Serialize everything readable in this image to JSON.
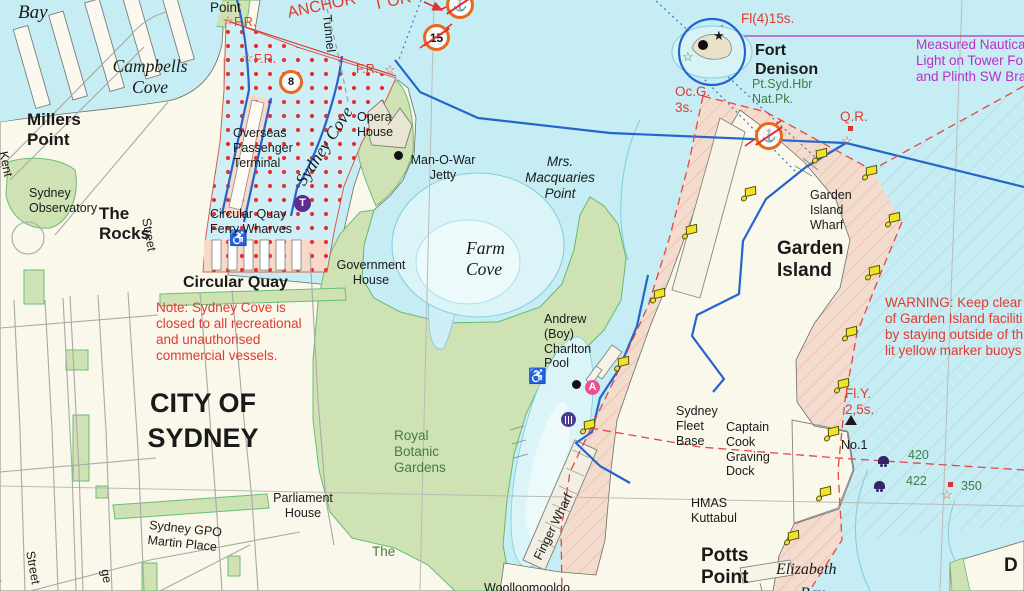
{
  "meta": {
    "description": "Nautical chart extract of Sydney Harbour: Sydney Cove, Farm Cove, Woolloomooloo Bay, Garden Island and Fort Denison",
    "colors": {
      "water": "#c5edf3",
      "shallow_water": "#daf4f7",
      "land": "#faf7eb",
      "park_green": "#cfe2b4",
      "restricted_salmon": "#f7d9c9",
      "red_dots": "#e63232",
      "boundary_blue": "#2365cc",
      "warning_red": "#e23a2e",
      "magenta": "#b92fc6",
      "green_text": "#3f7d46",
      "yellow_buoy": "#f2e32a",
      "purple": "#5b2d8e",
      "orange_badge": "#e8681c"
    }
  },
  "map": {
    "labels": [
      {
        "n": "bay-label",
        "t": [
          "Bay"
        ],
        "x": 18,
        "y": 2,
        "s": "ser20"
      },
      {
        "n": "dawes-point-label",
        "t": [
          "Point"
        ],
        "x": 210,
        "y": 0,
        "s": "p14"
      },
      {
        "n": "anchor-warning-line1",
        "t": [
          "T OR"
        ],
        "x": 372,
        "y": -3,
        "s": "red16",
        "r": -12
      },
      {
        "n": "anchor-warning-line2",
        "t": [
          "ANCHOR"
        ],
        "x": 286,
        "y": 5,
        "s": "red16",
        "r": -12
      },
      {
        "n": "light-fr-1",
        "t": [
          "F.R."
        ],
        "x": 234,
        "y": 15,
        "s": "red13"
      },
      {
        "n": "light-fr-2",
        "t": [
          "F.R."
        ],
        "x": 254,
        "y": 52,
        "s": "red13"
      },
      {
        "n": "light-fr-3",
        "t": [
          "F.R."
        ],
        "x": 356,
        "y": 62,
        "s": "red13"
      },
      {
        "n": "tunnel-label",
        "t": [
          "Tunnel"
        ],
        "x": 334,
        "y": 14,
        "s": "p13",
        "r": 84
      },
      {
        "n": "campbells-cove-label",
        "t": [
          "Campbells",
          "Cove"
        ],
        "x": 150,
        "y": 56,
        "s": "ser19 ctr"
      },
      {
        "n": "millers-point-label",
        "t": [
          "Millers",
          "Point"
        ],
        "x": 27,
        "y": 110,
        "s": "b18"
      },
      {
        "n": "sydney-cove-label",
        "t": [
          "Sydney Cove"
        ],
        "x": 291,
        "y": 178,
        "s": "ser19",
        "r": -57
      },
      {
        "n": "overseas-terminal-label",
        "t": [
          "Overseas",
          "Passenger",
          "Terminal"
        ],
        "x": 233,
        "y": 126,
        "s": "p13"
      },
      {
        "n": "kent-street-label",
        "t": [
          "Kent"
        ],
        "x": 10,
        "y": 150,
        "s": "p13",
        "r": 78
      },
      {
        "n": "sydney-observatory-label",
        "t": [
          "Sydney",
          "Observatory"
        ],
        "x": 29,
        "y": 186,
        "s": "p13"
      },
      {
        "n": "the-rocks-label",
        "t": [
          "The",
          "Rocks"
        ],
        "x": 99,
        "y": 204,
        "s": "b18"
      },
      {
        "n": "street-label-1",
        "t": [
          "Street"
        ],
        "x": 153,
        "y": 217,
        "s": "p13",
        "r": 80
      },
      {
        "n": "ferry-wharves-label",
        "t": [
          "Circular Quay",
          "Ferry Wharves"
        ],
        "x": 210,
        "y": 207,
        "s": "p13"
      },
      {
        "n": "circular-quay-label",
        "t": [
          "Circular Quay"
        ],
        "x": 183,
        "y": 274,
        "s": "b17"
      },
      {
        "n": "sydney-cove-note",
        "t": [
          "Note: Sydney Cove is",
          "closed to all recreational",
          "and unauthorised",
          "commercial vessels."
        ],
        "x": 156,
        "y": 300,
        "s": "red14"
      },
      {
        "n": "city-of-sydney-label",
        "t": [
          "CITY OF",
          "SYDNEY"
        ],
        "x": 203,
        "y": 386,
        "s": "b28 ctr"
      },
      {
        "n": "opera-house-label",
        "t": [
          "Opera",
          "House"
        ],
        "x": 357,
        "y": 110,
        "s": "p13"
      },
      {
        "n": "man-o-war-jetty-label",
        "t": [
          "Man-O-War",
          "Jetty"
        ],
        "x": 443,
        "y": 153,
        "s": "p13 ctr"
      },
      {
        "n": "mrs-macquaries-label",
        "t": [
          "Mrs.",
          "Macquaries",
          "Point"
        ],
        "x": 560,
        "y": 154,
        "s": "it14 ctr"
      },
      {
        "n": "farm-cove-label",
        "t": [
          "Farm",
          "Cove"
        ],
        "x": 466,
        "y": 238,
        "s": "ser19"
      },
      {
        "n": "government-house-label",
        "t": [
          "Government",
          "House"
        ],
        "x": 371,
        "y": 258,
        "s": "p13 ctr"
      },
      {
        "n": "royal-botanic-label",
        "t": [
          "Royal",
          "Botanic",
          "Gardens"
        ],
        "x": 394,
        "y": 428,
        "s": "grn14"
      },
      {
        "n": "charlton-pool-label",
        "t": [
          "Andrew",
          "(Boy)",
          "Charlton",
          "Pool"
        ],
        "x": 544,
        "y": 312,
        "s": "p13"
      },
      {
        "n": "parliament-house-label",
        "t": [
          "Parliament",
          "House"
        ],
        "x": 303,
        "y": 491,
        "s": "p13 ctr"
      },
      {
        "n": "gpo-martin-place-label",
        "t": [
          "Sydney GPO",
          "Martin Place"
        ],
        "x": 150,
        "y": 518,
        "s": "p13",
        "r": 6
      },
      {
        "n": "the-domain-label",
        "t": [
          "The"
        ],
        "x": 372,
        "y": 544,
        "s": "grn14"
      },
      {
        "n": "woolloomooloo-label",
        "t": [
          "Woolloomooloo"
        ],
        "x": 484,
        "y": 581,
        "s": "p13"
      },
      {
        "n": "finger-wharf-label",
        "t": [
          "Finger Wharf"
        ],
        "x": 531,
        "y": 556,
        "s": "p13",
        "r": -64
      },
      {
        "n": "fleet-base-label",
        "t": [
          "Sydney",
          "Fleet",
          "Base"
        ],
        "x": 676,
        "y": 404,
        "s": "p13"
      },
      {
        "n": "graving-dock-label",
        "t": [
          "Captain",
          "Cook",
          "Graving",
          "Dock"
        ],
        "x": 726,
        "y": 420,
        "s": "p13"
      },
      {
        "n": "hmas-kuttabul-label",
        "t": [
          "HMAS",
          "Kuttabul"
        ],
        "x": 691,
        "y": 496,
        "s": "p13"
      },
      {
        "n": "potts-point-label",
        "t": [
          "Potts",
          "Point"
        ],
        "x": 701,
        "y": 545,
        "s": "b19"
      },
      {
        "n": "elizabeth-bay-label",
        "t": [
          "Elizabeth"
        ],
        "x": 776,
        "y": 561,
        "s": "ser17"
      },
      {
        "n": "elizabeth-bay-label-2",
        "t": [
          "Bay"
        ],
        "x": 800,
        "y": 585,
        "s": "ser17"
      },
      {
        "n": "garden-island-wharf-label",
        "t": [
          "Garden",
          "Island",
          "Wharf"
        ],
        "x": 810,
        "y": 188,
        "s": "p13"
      },
      {
        "n": "garden-island-label",
        "t": [
          "Garden",
          "Island"
        ],
        "x": 777,
        "y": 238,
        "s": "b19"
      },
      {
        "n": "warning-note",
        "t": [
          "WARNING: Keep clear",
          "of Garden Island faciliti",
          "by staying outside of th",
          "lit yellow marker buoys"
        ],
        "x": 885,
        "y": 295,
        "s": "red14"
      },
      {
        "n": "fort-denison-label",
        "t": [
          "Fort",
          "Denison"
        ],
        "x": 755,
        "y": 42,
        "s": "b17"
      },
      {
        "n": "fort-denison-park-label",
        "t": [
          "Pt.Syd.Hbr",
          "Nat.Pk."
        ],
        "x": 752,
        "y": 77,
        "s": "grn13"
      },
      {
        "n": "light-ocg",
        "t": [
          "Oc.G.",
          "3s."
        ],
        "x": 675,
        "y": 84,
        "s": "red14"
      },
      {
        "n": "light-fl4",
        "t": [
          "Fl(4)15s."
        ],
        "x": 741,
        "y": 11,
        "s": "red14"
      },
      {
        "n": "measured-mile-note",
        "t": [
          "Measured Nautica",
          "Light on Tower Fo",
          "and Plinth SW Bra"
        ],
        "x": 916,
        "y": 37,
        "s": "mag14"
      },
      {
        "n": "light-qr",
        "t": [
          "Q.R."
        ],
        "x": 840,
        "y": 109,
        "s": "red14"
      },
      {
        "n": "light-fly",
        "t": [
          "Fl.Y.",
          "2,5s."
        ],
        "x": 845,
        "y": 386,
        "s": "red14"
      },
      {
        "n": "buoy-no1-label",
        "t": [
          "No.1"
        ],
        "x": 841,
        "y": 438,
        "s": "p13"
      },
      {
        "n": "depth-420",
        "t": [
          "420"
        ],
        "x": 908,
        "y": 448,
        "s": "grn13"
      },
      {
        "n": "depth-422",
        "t": [
          "422"
        ],
        "x": 906,
        "y": 474,
        "s": "grn13"
      },
      {
        "n": "mark-350",
        "t": [
          "350"
        ],
        "x": 961,
        "y": 479,
        "s": "grn13"
      },
      {
        "n": "street-label-2",
        "t": [
          "Street"
        ],
        "x": 37,
        "y": 550,
        "s": "p13",
        "r": 80
      },
      {
        "n": "george-street-partial",
        "t": [
          "ge"
        ],
        "x": 112,
        "y": 568,
        "s": "p13",
        "r": 80
      },
      {
        "n": "street-partial-s",
        "t": [
          "s"
        ],
        "x": 1,
        "y": 313,
        "s": "p13",
        "r": 75
      },
      {
        "n": "street-partial-d",
        "t": [
          "d"
        ],
        "x": 1,
        "y": 575,
        "s": "p13",
        "r": 75
      },
      {
        "n": "darling-point-partial",
        "t": [
          "D"
        ],
        "x": 1004,
        "y": 555,
        "s": "b19"
      }
    ],
    "stars": [
      {
        "n": "star-fr-1-icon",
        "g": "☆",
        "x": 222,
        "y": 14,
        "c": "#e8562c"
      },
      {
        "n": "star-fr-2-icon",
        "g": "☆",
        "x": 242,
        "y": 51,
        "c": "#e8562c"
      },
      {
        "n": "star-fr-3-icon",
        "g": "☆",
        "x": 384,
        "y": 63,
        "c": "#e8562c"
      },
      {
        "n": "star-qr-icon",
        "g": "☆",
        "x": 841,
        "y": 134,
        "c": "#e8562c"
      },
      {
        "n": "star-350-icon",
        "g": "☆",
        "x": 941,
        "y": 488,
        "c": "#e8562c"
      },
      {
        "n": "star-fort-park-icon",
        "g": "☆",
        "x": 682,
        "y": 50,
        "c": "#2e8b46"
      },
      {
        "n": "star-fort-icon",
        "g": "★",
        "x": 713,
        "y": 29,
        "c": "#1a1a1a"
      }
    ],
    "squares": [
      {
        "n": "qr-light-square",
        "x": 848,
        "y": 126
      },
      {
        "n": "mark-350-square",
        "x": 948,
        "y": 482
      }
    ],
    "dots": [
      {
        "n": "man-o-war-dot",
        "x": 394,
        "y": 151,
        "d": 9
      },
      {
        "n": "pool-dot",
        "x": 572,
        "y": 380,
        "d": 9
      },
      {
        "n": "fort-dot",
        "x": 698,
        "y": 40,
        "d": 10
      }
    ],
    "discs": [
      {
        "n": "train-station-icon",
        "t": "T",
        "x": 294,
        "y": 195,
        "d": 17,
        "c": "#5b2d8e"
      },
      {
        "n": "anchorage-a-icon",
        "t": "A",
        "x": 585,
        "y": 380,
        "d": 15,
        "c": "#ee4d92"
      }
    ],
    "badges": [
      {
        "n": "marker-8-badge",
        "t": "8",
        "x": 279,
        "y": 70,
        "d": 18,
        "slash": false,
        "fs": 11
      },
      {
        "n": "speed-limit-15-badge",
        "t": "15",
        "x": 423,
        "y": 24,
        "d": 21,
        "slash": true,
        "fs": 12
      },
      {
        "n": "no-anchoring-icon-1",
        "t": "⚓",
        "x": 446,
        "y": -9,
        "d": 22,
        "slash": true,
        "fs": 12
      },
      {
        "n": "no-anchoring-icon-2",
        "t": "⚓",
        "x": 755,
        "y": 122,
        "d": 22,
        "slash": true,
        "fs": 12
      }
    ],
    "wheelchairs": [
      {
        "n": "wheelchair-icon-quay",
        "g": "♿",
        "x": 229,
        "y": 231
      },
      {
        "n": "wheelchair-icon-pool",
        "g": "♿",
        "x": 528,
        "y": 369
      }
    ],
    "buoys": [
      [
        816,
        149
      ],
      [
        866,
        166
      ],
      [
        889,
        213
      ],
      [
        869,
        266
      ],
      [
        846,
        327
      ],
      [
        838,
        379
      ],
      [
        828,
        427
      ],
      [
        820,
        487
      ],
      [
        788,
        531
      ],
      [
        686,
        225
      ],
      [
        654,
        289
      ],
      [
        618,
        357
      ],
      [
        584,
        420
      ],
      [
        745,
        187
      ]
    ],
    "moorings": [
      {
        "n": "mooring-pile-420",
        "x": 878,
        "y": 456
      },
      {
        "n": "mooring-pile-422",
        "x": 874,
        "y": 481
      }
    ],
    "cone": {
      "n": "no1-cone-icon",
      "x": 845,
      "y": 415
    },
    "amenity": {
      "n": "memorial-icon",
      "x": 561,
      "y": 412
    }
  }
}
